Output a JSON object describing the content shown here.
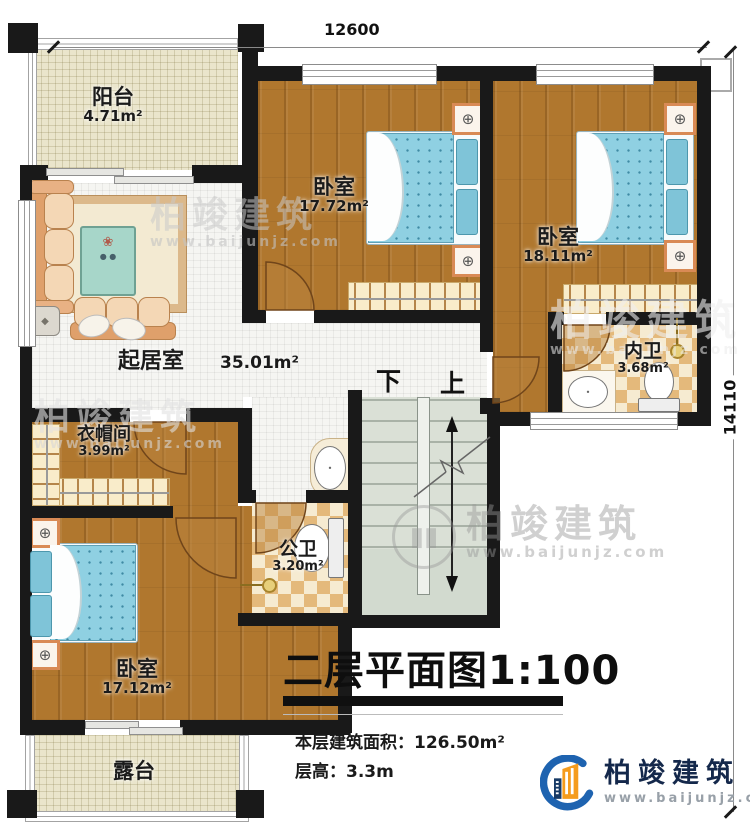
{
  "plan": {
    "title": "二层平面图1:100",
    "stats": {
      "area_line": "本层建筑面积：126.50m²",
      "floor_height_line": "层高：3.3m"
    },
    "dimensions": {
      "top": "12600",
      "right": "14110"
    },
    "rooms": {
      "balcony": {
        "name": "阳台",
        "area": "4.71m²"
      },
      "bedroom_top": {
        "name": "卧室",
        "area": "17.72m²"
      },
      "bedroom_right": {
        "name": "卧室",
        "area": "18.11m²"
      },
      "ensuite_bath": {
        "name": "内卫",
        "area": "3.68m²"
      },
      "living_room": {
        "name": "起居室",
        "area": "35.01m²"
      },
      "cloakroom": {
        "name": "衣帽间",
        "area": "3.99m²"
      },
      "public_bath": {
        "name": "公卫",
        "area": "3.20m²"
      },
      "bedroom_bottom": {
        "name": "卧室",
        "area": "17.12m²"
      },
      "terrace": {
        "name": "露台"
      }
    },
    "stairs": {
      "down_label": "下",
      "up_label": "上"
    }
  },
  "branding": {
    "company": "柏竣建筑",
    "website": "www.baijunjz.com"
  },
  "watermark": {
    "company": "柏竣建筑",
    "website": "www.baijunjz.com"
  },
  "colors": {
    "wall": "#191919",
    "wood_floor": "#b0772e",
    "tile_checker": "#e4b97b",
    "stair": "#dae0d6",
    "bed_mattress": "#8fd0e2",
    "balcony_floor": "#eae5cb",
    "logo_blue": "#1e63b0",
    "logo_orange": "#f59c1d"
  }
}
